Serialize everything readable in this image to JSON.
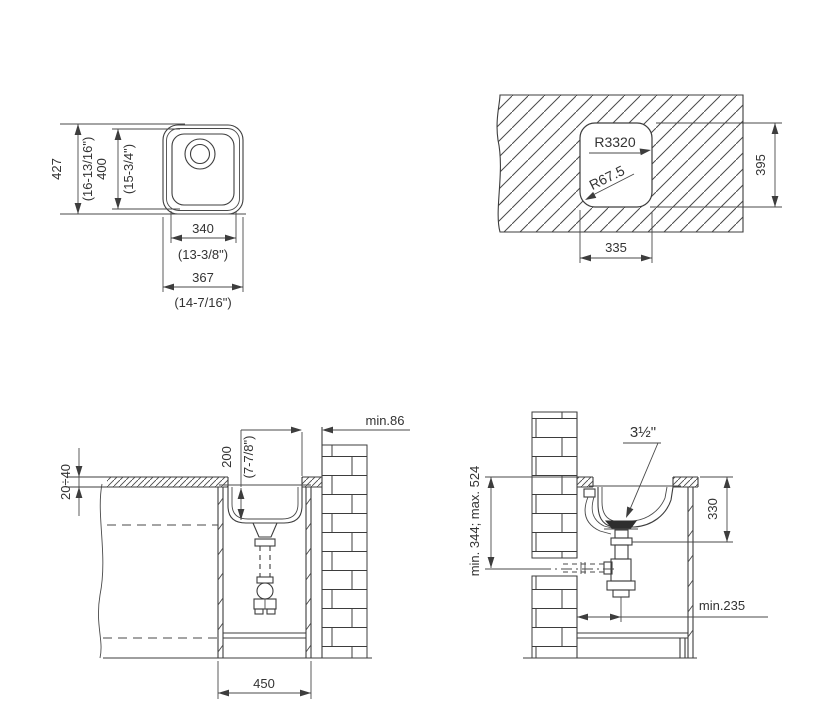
{
  "drawing_title": "Sink installation technical drawing",
  "colors": {
    "line": "#3d3d3d",
    "background": "#ffffff",
    "strainer_fill": "#2e2e2e"
  },
  "labels": {
    "tl": {
      "h_mm": "427",
      "h_in": "(16-13/16\")",
      "bowl_h_mm": "400",
      "bowl_h_in": "(15-3/4\")",
      "bowl_w_mm": "340",
      "bowl_w_in": "(13-3/8\")",
      "w_mm": "367",
      "w_in": "(14-7/16\")"
    },
    "tr": {
      "r_big": "R3320",
      "r_small": "R67.5",
      "cut_h": "395",
      "cut_w": "335"
    },
    "bl": {
      "wall_gap": "min.86",
      "depth_mm": "200",
      "depth_in": "(7-7/8\")",
      "counter_th": "20÷40",
      "cab_w": "450"
    },
    "br": {
      "drain": "3½\"",
      "range": "min. 344; max. 524",
      "top_to_drain": "330",
      "offset": "min.235"
    }
  }
}
